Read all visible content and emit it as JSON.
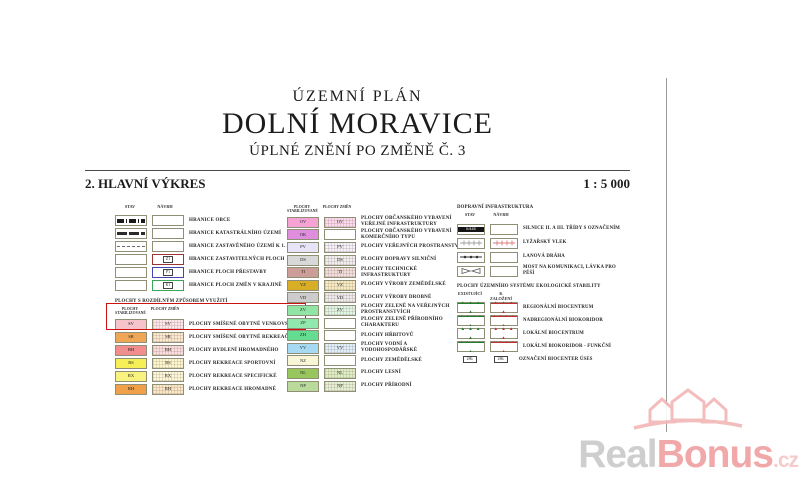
{
  "header": {
    "doc_type": "ÚZEMNÍ PLÁN",
    "title": "DOLNÍ MORAVICE",
    "subtitle": "ÚPLNÉ ZNĚNÍ PO ZMĚNĚ Č. 3",
    "sheet_title": "2. HLAVNÍ VÝKRES",
    "scale": "1 : 5 000"
  },
  "boundaries": {
    "col_stav": "STAV",
    "col_navrh": "NÁVRH",
    "rows": [
      {
        "label": "HRANICE OBCE"
      },
      {
        "label": "HRANICE KATASTRÁLNÍHO ÚZEMÍ"
      },
      {
        "label": "HRANICE ZASTAVĚNÉHO ÚZEMÍ K 1. 11. 2021"
      },
      {
        "label": "HRANICE ZASTAVITELNÝCH PLOCH",
        "tag": "Z1",
        "border_color": "#9c3434"
      },
      {
        "label": "HRANICE PLOCH PŘESTAVBY",
        "tag": "P1",
        "border_color": "#4747ab"
      },
      {
        "label": "HRANICE PLOCH ZMĚN V KRAJINĚ",
        "tag": "K1",
        "border_color": "#3aa657"
      }
    ]
  },
  "areas1": {
    "section_title": "PLOCHY S ROZDÍLNÝM ZPŮSOBEM VYUŽITÍ",
    "col_stable": "PLOCHY STABILIZOVANÉ",
    "col_change": "PLOCHY ZMĚN",
    "highlight_color": "#cc1111",
    "rows": [
      {
        "code": "SV",
        "label": "PLOCHY SMÍŠENÉ OBYTNÉ VENKOVSKÉ",
        "color": "#f6c3cb",
        "change_color": "#fbe7ea"
      },
      {
        "code": "SR",
        "label": "PLOCHY SMÍŠENÉ OBYTNÉ REKREAČNÍ",
        "color": "#efa757",
        "change_color": "#f9e9cf"
      },
      {
        "code": "BH",
        "label": "PLOCHY BYDLENÍ HROMADNÉHO",
        "color": "#f18d8d",
        "change_color": "#fadede"
      },
      {
        "code": "RS",
        "label": "PLOCHY REKREACE SPORTOVNÍ",
        "color": "#f6ef55",
        "change_color": "#fbf8ce"
      },
      {
        "code": "RX",
        "label": "PLOCHY REKREACE SPECIFICKÉ",
        "color": "#f8f37e",
        "change_color": "#fcf9d8"
      },
      {
        "code": "RH",
        "label": "PLOCHY REKREACE HROMADNÉ",
        "color": "#efa049",
        "change_color": "#f9e8c7"
      }
    ]
  },
  "areas2": {
    "col_stable": "PLOCHY STABILIZOVANÉ",
    "col_change": "PLOCHY ZMĚN",
    "rows": [
      {
        "code": "OV",
        "label": "PLOCHY OBČANSKÉHO VYBAVENÍ VEŘEJNÉ INFRASTRUKTURY",
        "color": "#f5a3d5",
        "change_color": "#fbdcef"
      },
      {
        "code": "OK",
        "label": "PLOCHY OBČANSKÉHO VYBAVENÍ KOMERČNÍHO TYPU",
        "color": "#df8ede",
        "change_color": ""
      },
      {
        "code": "PV",
        "label": "PLOCHY VEŘEJNÝCH PROSTRANSTVÍ",
        "color": "#e6e4f6",
        "change_color": "#f4f3fb"
      },
      {
        "code": "DS",
        "label": "PLOCHY DOPRAVY SILNIČNÍ",
        "color": "#d8d8d8",
        "change_color": "#efefef"
      },
      {
        "code": "TI",
        "label": "PLOCHY TECHNICKÉ INFRASTRUKTURY",
        "color": "#cd9d97",
        "change_color": "#f1dfdc"
      },
      {
        "code": "VZ",
        "label": "PLOCHY VÝROBY ZEMĚDĚLSKÉ",
        "color": "#d9ae27",
        "change_color": "#f5ecc3"
      },
      {
        "code": "VD",
        "label": "PLOCHY VÝROBY DROBNÉ",
        "color": "#cccccc",
        "change_color": "#ececec"
      },
      {
        "code": "ZV",
        "label": "PLOCHY ZELENĚ NA VEŘEJNÝCH PROSTRANSTVÍCH",
        "color": "#8fe5a4",
        "change_color": "#def7e4"
      },
      {
        "code": "ZP",
        "label": "PLOCHY ZELENĚ PŘÍRODNÍHO CHARAKTERU",
        "color": "#90e8ae",
        "change_color": ""
      },
      {
        "code": "ZH",
        "label": "PLOCHY HŘBITOVŮ",
        "color": "#64dd91",
        "change_color": ""
      },
      {
        "code": "VV",
        "label": "PLOCHY VODNÍ A VODOHOSPODÁŘSKÉ",
        "color": "#a6d9f2",
        "change_color": "#def0fa"
      },
      {
        "code": "NZ",
        "label": "PLOCHY ZEMĚDĚLSKÉ",
        "color": "#f9f6d8",
        "change_color": ""
      },
      {
        "code": "NL",
        "label": "PLOCHY LESNÍ",
        "color": "#97c65c",
        "change_color": "#ddf0c4"
      },
      {
        "code": "NP",
        "label": "PLOCHY PŘÍRODNÍ",
        "color": "#b9da9b",
        "change_color": "#e4f2d4"
      }
    ]
  },
  "transport": {
    "section_title": "DOPRAVNÍ INFRASTRUKTURA",
    "col_stav": "STAV",
    "col_navrh": "NÁVRH",
    "road_label": "II/445",
    "lift_existing_color": "#a0a0a0",
    "lift_proposed_color": "#dd7e7e",
    "rows": [
      {
        "label": "SILNICE II. A III. TŘÍDY S OZNAČENÍM"
      },
      {
        "label": "LYŽAŘSKÝ VLEK"
      },
      {
        "label": "LANOVÁ DRÁHA"
      },
      {
        "label": "MOST NA KOMUNIKACI, LÁVKA PRO PĚŠÍ"
      }
    ]
  },
  "uses": {
    "section_title": "PLOCHY ÚZEMNÍHO SYSTÉMU EKOLOGICKÉ STABILITY",
    "col_existing": "EXISTUJÍCÍ",
    "col_proposed": "K ZALOŽENÍ",
    "existing_color": "#1f7d2c",
    "proposed_color": "#c03030",
    "biocenter_tag": "286.",
    "rows": [
      {
        "label": "REGIONÁLNÍ BIOCENTRUM"
      },
      {
        "label": "NADREGIONÁLNÍ BIOKORIDOR"
      },
      {
        "label": "LOKÁLNÍ BIOCENTRUM"
      },
      {
        "label": "LOKÁLNÍ BIOKORIDOR - FUNKČNÍ"
      },
      {
        "label": "OZNAČENÍ BIOCENTER ÚSES"
      }
    ]
  },
  "watermark": {
    "part1": "Real",
    "part2": "Bonus",
    "part3": ".cz",
    "gray": "#c9c9c9",
    "pink": "#ef9f9f",
    "light_pink": "#f6c6c6",
    "logo_pink": "#f2b6b6"
  }
}
